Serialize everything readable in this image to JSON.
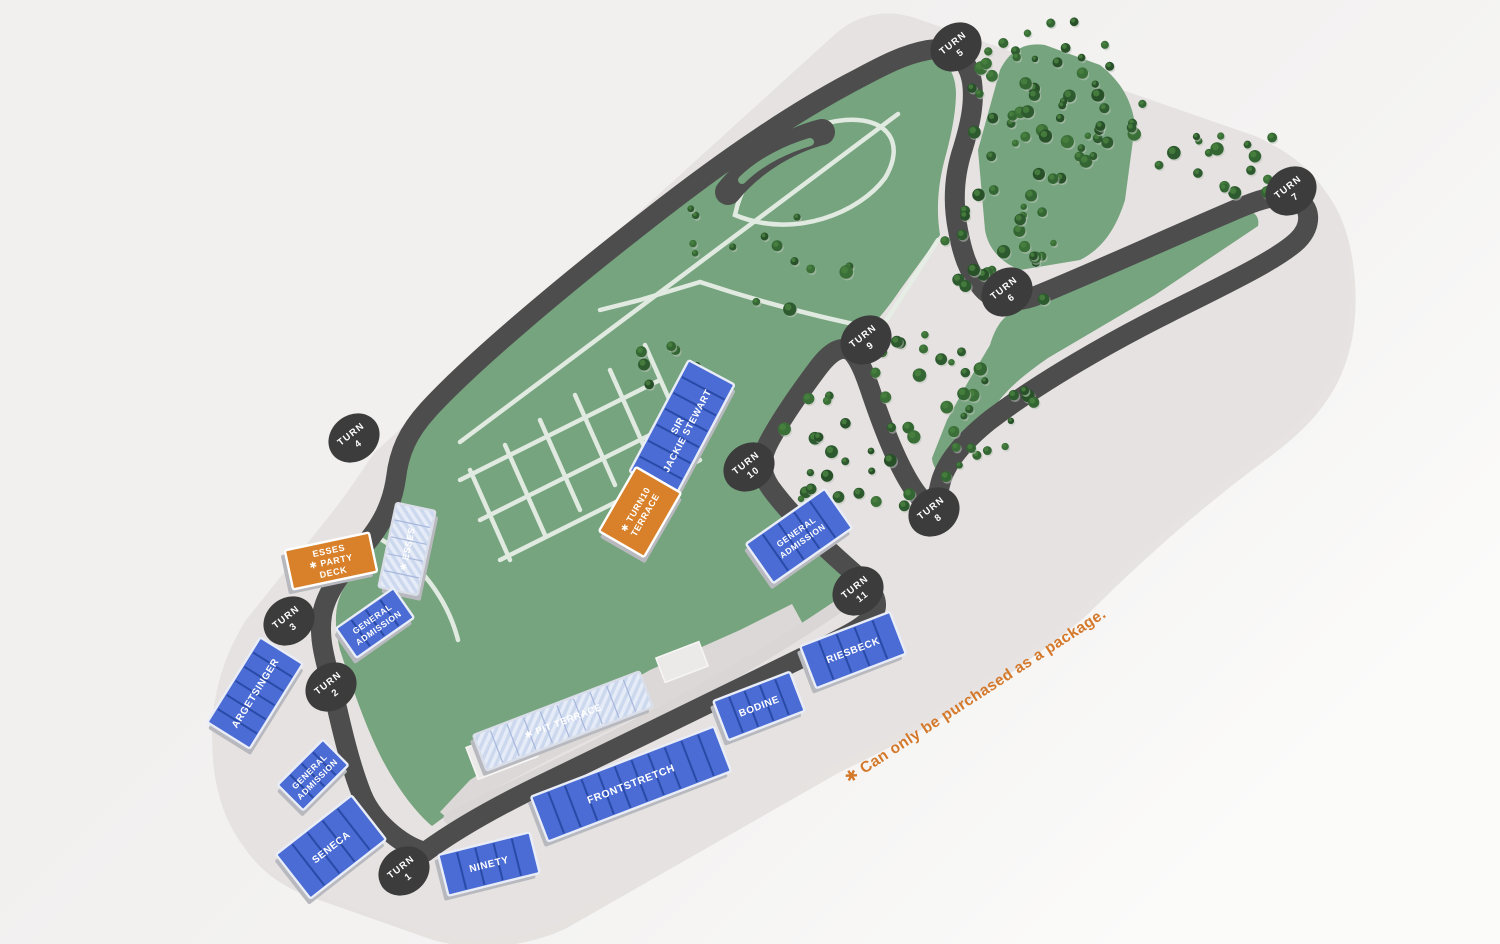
{
  "map": {
    "note": "✱ Can only be purchased as a package.",
    "turn_badge_word": "TURN",
    "colors": {
      "background": "#f1f0ef",
      "grounds": "#e6e2e1",
      "grounds_shadow": "#d8d4d2",
      "track": "#4d4d4d",
      "infield_green": "#76a47e",
      "road": "#e7eee6",
      "paddock": "#dcd8d7",
      "building": "#eceae9",
      "stand_blue": "#4a6cd4",
      "stand_stripe": "#2a4aa8",
      "stand_package_bg": "#ccd8ee",
      "stand_package_stripe": "#a8b8dd",
      "stand_orange": "#d9812a",
      "stand_side": "#b8b9be",
      "badge": "#3c3c3c",
      "tree_dark": "#2d5a2e",
      "tree_mid": "#336633",
      "tree_light": "#49813f",
      "note_orange": "#d4782a"
    },
    "turns": [
      {
        "number": "1",
        "cx": 404,
        "cy": 871
      },
      {
        "number": "2",
        "cx": 331,
        "cy": 687
      },
      {
        "number": "3",
        "cx": 289,
        "cy": 621
      },
      {
        "number": "4",
        "cx": 354,
        "cy": 438
      },
      {
        "number": "5",
        "cx": 956,
        "cy": 47
      },
      {
        "number": "6",
        "cx": 1007,
        "cy": 292
      },
      {
        "number": "7",
        "cx": 1291,
        "cy": 191
      },
      {
        "number": "8",
        "cx": 934,
        "cy": 512
      },
      {
        "number": "9",
        "cx": 866,
        "cy": 340
      },
      {
        "number": "10",
        "cx": 749,
        "cy": 467
      },
      {
        "number": "11",
        "cx": 858,
        "cy": 591
      }
    ],
    "stands": [
      {
        "id": "argetsinger",
        "label": [
          "ARGETSINGER"
        ],
        "type": "reserved",
        "cx": 255,
        "cy": 693,
        "w": 100,
        "h": 50,
        "rot": -58,
        "fs": 10
      },
      {
        "id": "general-admission-1",
        "label": [
          "GENERAL",
          "ADMISSION"
        ],
        "type": "reserved",
        "cx": 313,
        "cy": 775,
        "w": 64,
        "h": 36,
        "rot": -45,
        "fs": 8.5
      },
      {
        "id": "seneca",
        "label": [
          "SENECA"
        ],
        "type": "reserved",
        "cx": 331,
        "cy": 847,
        "w": 96,
        "h": 56,
        "rot": -38,
        "fs": 10
      },
      {
        "id": "ninety",
        "label": [
          "NINETY"
        ],
        "type": "reserved",
        "cx": 489,
        "cy": 864,
        "w": 94,
        "h": 42,
        "rot": -14,
        "fs": 10
      },
      {
        "id": "frontstretch",
        "label": [
          "FRONTSTRETCH"
        ],
        "type": "reserved",
        "cx": 631,
        "cy": 784,
        "w": 196,
        "h": 48,
        "rot": -21,
        "fs": 10.5
      },
      {
        "id": "pit-terrace",
        "label": [
          "✱ PIT TERRACE"
        ],
        "type": "package",
        "cx": 563,
        "cy": 721,
        "w": 178,
        "h": 38,
        "rot": -21,
        "fs": 9.5
      },
      {
        "id": "bodine",
        "label": [
          "BODINE"
        ],
        "type": "reserved",
        "cx": 759,
        "cy": 706,
        "w": 82,
        "h": 42,
        "rot": -21,
        "fs": 10
      },
      {
        "id": "riesbeck",
        "label": [
          "RIESBECK"
        ],
        "type": "reserved",
        "cx": 853,
        "cy": 650,
        "w": 96,
        "h": 45,
        "rot": -21,
        "fs": 10
      },
      {
        "id": "general-admission-2",
        "label": [
          "GENERAL",
          "ADMISSION"
        ],
        "type": "reserved",
        "cx": 799,
        "cy": 536,
        "w": 96,
        "h": 48,
        "rot": -35,
        "fs": 8.5
      },
      {
        "id": "sir-jackie-stewart",
        "label": [
          "SIR",
          "JACKIE STEWART"
        ],
        "type": "reserved",
        "cx": 682,
        "cy": 428,
        "w": 126,
        "h": 52,
        "rot": -62,
        "fs": 9.5
      },
      {
        "id": "turn10-terrace",
        "label": [
          "✱ TURN10",
          "TERRACE"
        ],
        "type": "party",
        "cx": 640,
        "cy": 512,
        "w": 74,
        "h": 52,
        "rot": -60,
        "fs": 9
      },
      {
        "id": "esses",
        "label": [
          "✱ ESSES"
        ],
        "type": "package",
        "cx": 407,
        "cy": 549,
        "w": 86,
        "h": 40,
        "rot": -78,
        "fs": 9
      },
      {
        "id": "esses-party-deck",
        "label": [
          "ESSES",
          "✱ PARTY",
          "DECK"
        ],
        "type": "party",
        "cx": 331,
        "cy": 561,
        "w": 86,
        "h": 40,
        "rot": -12,
        "fs": 9
      },
      {
        "id": "general-admission-3",
        "label": [
          "GENERAL",
          "ADMISSION"
        ],
        "type": "reserved",
        "cx": 375,
        "cy": 623,
        "w": 70,
        "h": 36,
        "rot": -35,
        "fs": 8.5
      }
    ],
    "tree_clusters": [
      {
        "cx": 1055,
        "cy": 100,
        "rx": 88,
        "ry": 82,
        "count": 58
      },
      {
        "cx": 1002,
        "cy": 252,
        "rx": 62,
        "ry": 68,
        "count": 32
      },
      {
        "cx": 1225,
        "cy": 163,
        "rx": 78,
        "ry": 36,
        "count": 17
      },
      {
        "cx": 848,
        "cy": 462,
        "rx": 72,
        "ry": 76,
        "count": 30
      },
      {
        "cx": 985,
        "cy": 398,
        "rx": 58,
        "ry": 56,
        "count": 18
      },
      {
        "cx": 748,
        "cy": 255,
        "rx": 105,
        "ry": 62,
        "count": 14
      },
      {
        "cx": 905,
        "cy": 352,
        "rx": 42,
        "ry": 30,
        "count": 8
      },
      {
        "cx": 652,
        "cy": 352,
        "rx": 55,
        "ry": 40,
        "count": 7
      },
      {
        "cx": 962,
        "cy": 462,
        "rx": 30,
        "ry": 26,
        "count": 6
      }
    ]
  }
}
